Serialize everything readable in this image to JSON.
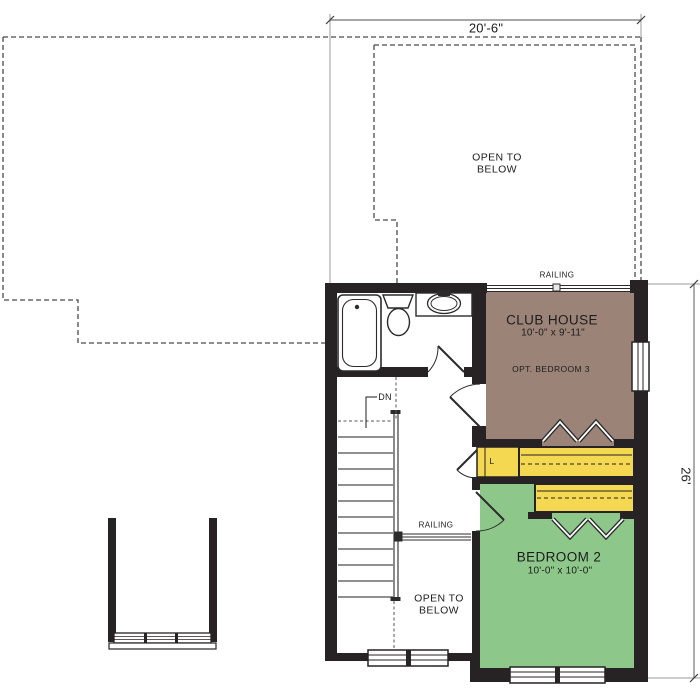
{
  "plan": {
    "type": "second-floor plan",
    "dimensions": {
      "top": "20'-6\"",
      "right": "26'"
    },
    "rooms": {
      "club_house": {
        "name": "CLUB HOUSE",
        "size": "10'-0\" x 9'-11\"",
        "note": "OPT. BEDROOM 3"
      },
      "bedroom_2": {
        "name": "BEDROOM 2",
        "size": "10'-0\" x 10'-0\""
      },
      "open_to_below_upper": {
        "label": "OPEN TO\nBELOW"
      },
      "open_to_below_lower": {
        "label": "OPEN TO\nBELOW"
      },
      "linen_closet": {
        "label": "L"
      }
    },
    "labels": {
      "railing_upper": "RAILING",
      "railing_lower": "RAILING",
      "stairs_down": "DN"
    },
    "colors": {
      "club_house_floor": "#9b8477",
      "bedroom_floor": "#8dc88a",
      "closet_shelf": "#f4d851",
      "wall": "#272223",
      "dash_line": "#4a4a4a",
      "dim_line": "#8a8a8a"
    }
  }
}
